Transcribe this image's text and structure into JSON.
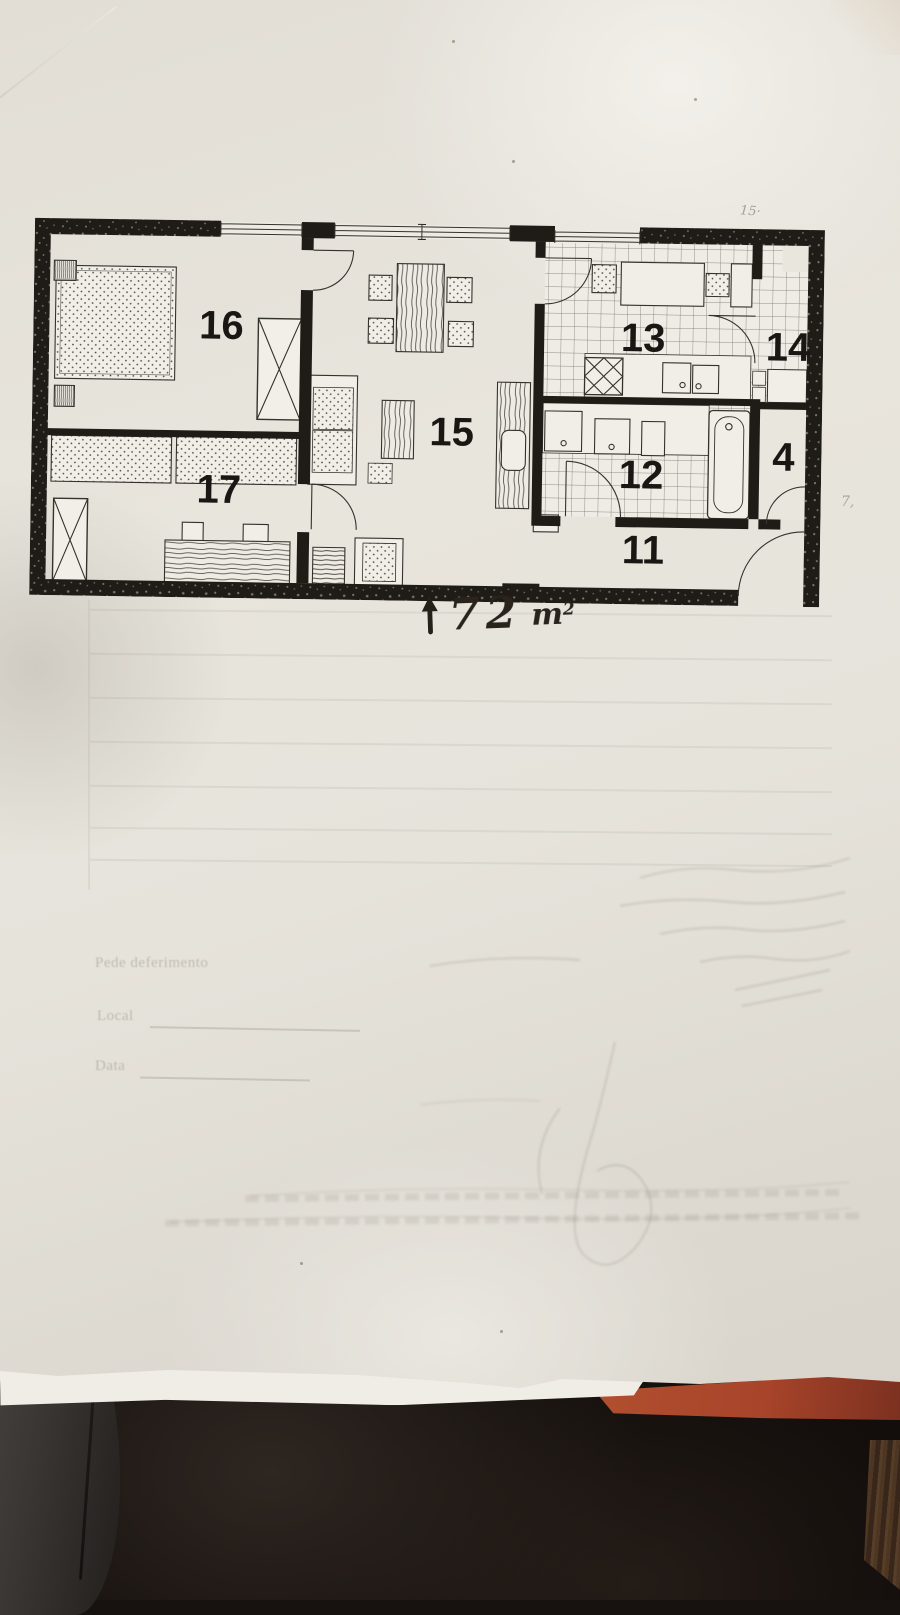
{
  "plan": {
    "rooms": [
      {
        "number": "16"
      },
      {
        "number": "17"
      },
      {
        "number": "15"
      },
      {
        "number": "13"
      },
      {
        "number": "14"
      },
      {
        "number": "12"
      },
      {
        "number": "11"
      },
      {
        "number": "4"
      }
    ],
    "area_value": "72",
    "area_unit": "m",
    "area_exponent": "2",
    "pencil_mark_top": "15·",
    "pencil_mark_right": "7,"
  },
  "ghost_form": {
    "petition_closing": "Pede deferimento",
    "place_label": "Local",
    "date_label": "Data"
  },
  "colors": {
    "paper": "#e6e3db",
    "plan_ink": "#1f1b17",
    "fabric": "#17120f",
    "folder_orange": "#a8442a"
  }
}
